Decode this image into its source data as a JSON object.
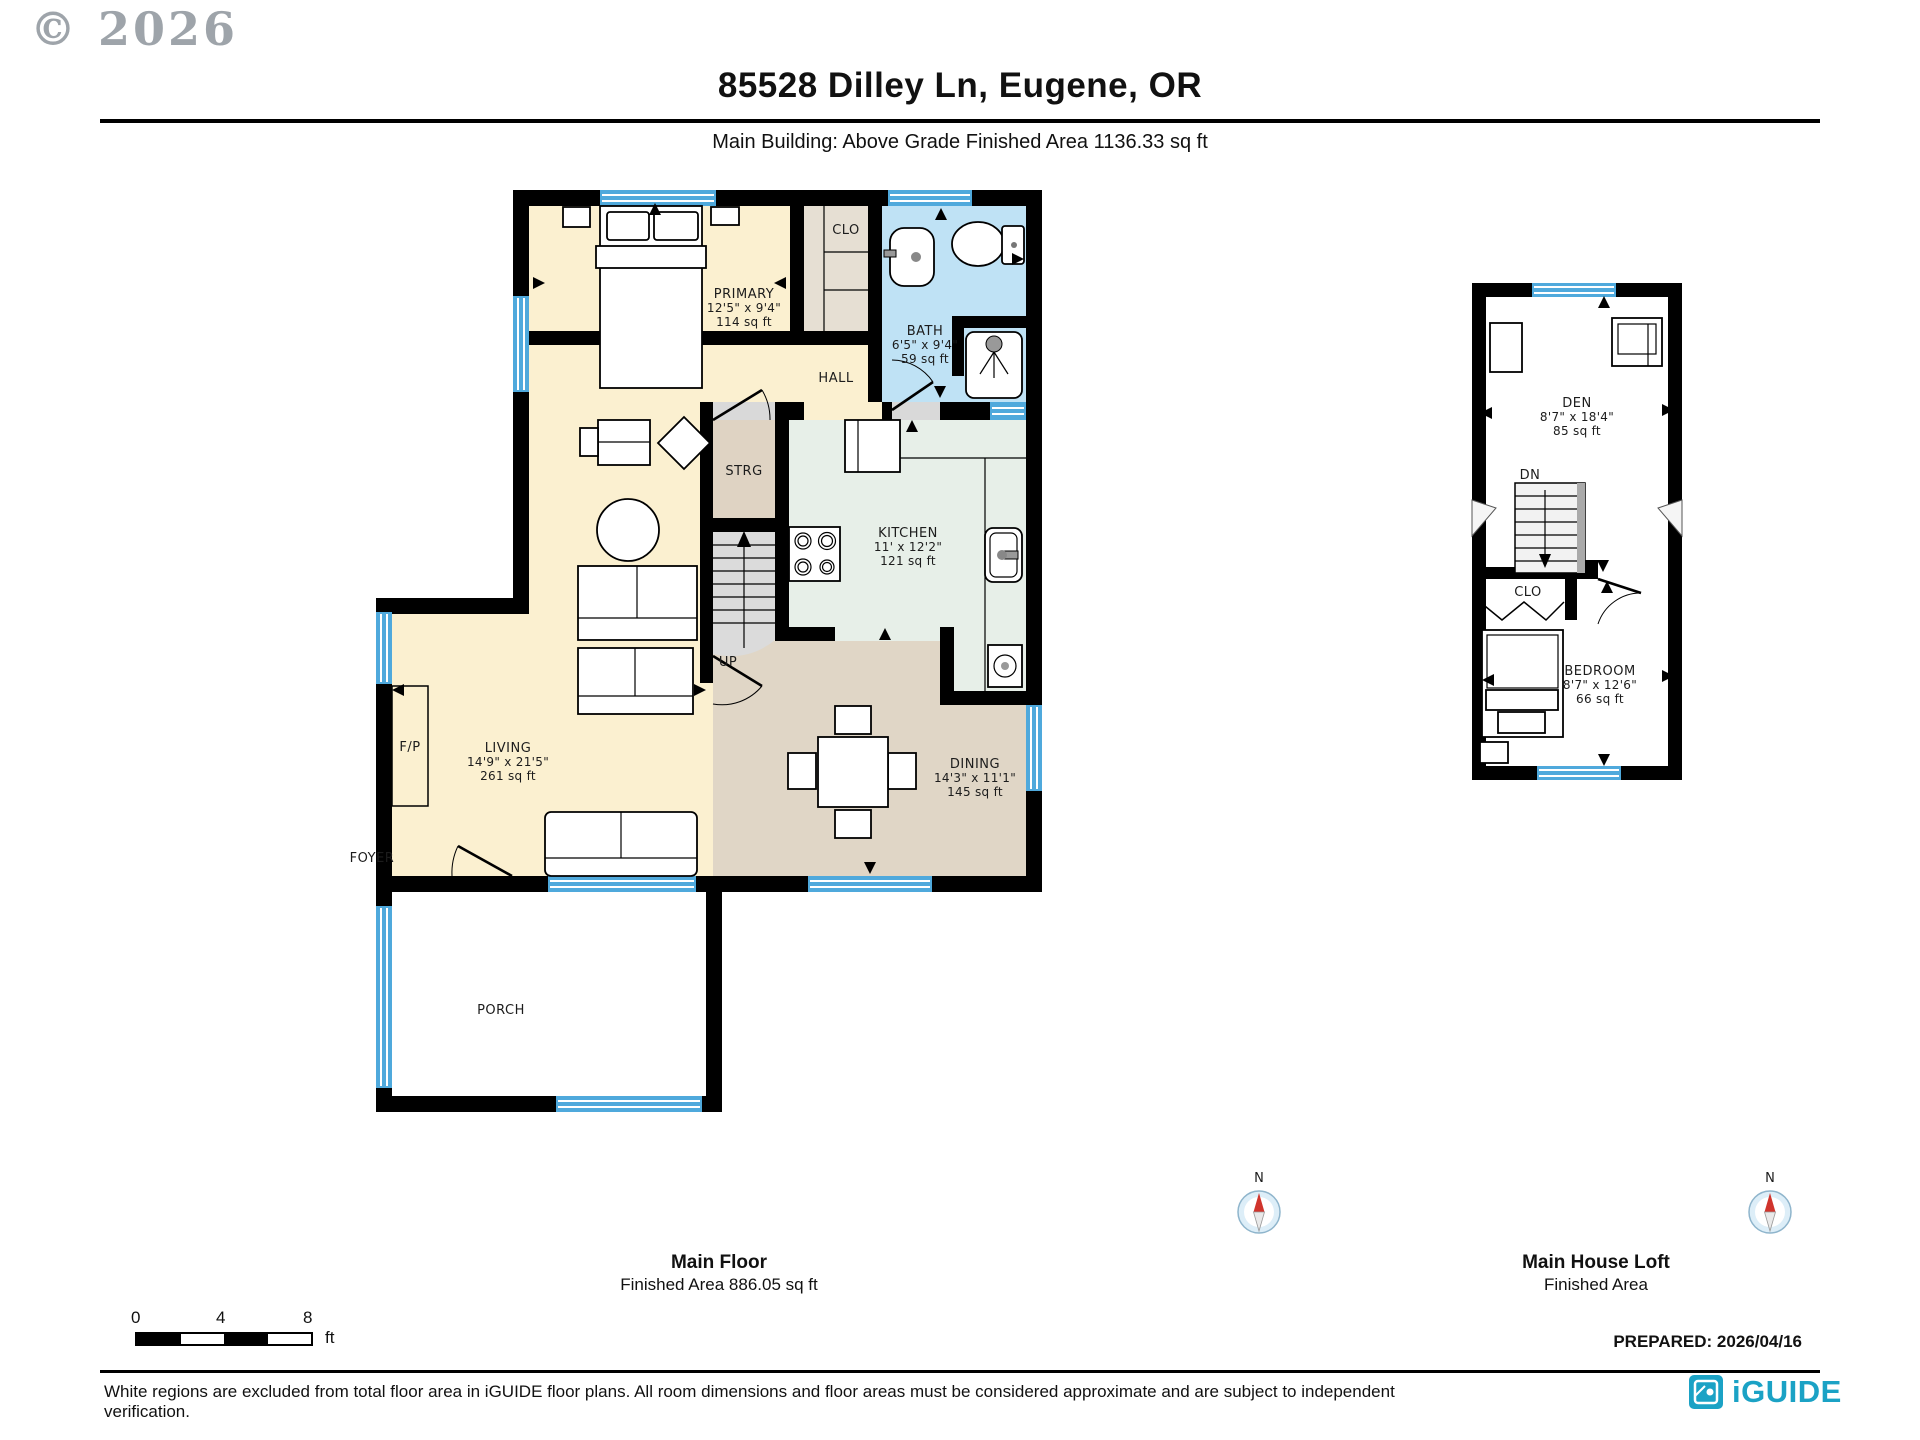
{
  "watermark": "© 2026",
  "header": {
    "title": "85528 Dilley Ln, Eugene, OR",
    "subtitle": "Main Building: Above Grade Finished Area 1136.33 sq ft"
  },
  "main_floor": {
    "caption": "Main Floor",
    "area_caption": "Finished Area 886.05 sq ft",
    "rooms": {
      "primary": {
        "label": "PRIMARY",
        "dims": "12'5\" x 9'4\"",
        "area": "114 sq ft"
      },
      "clo": {
        "label": "CLO"
      },
      "bath": {
        "label": "BATH",
        "dims": "6'5\" x 9'4\"",
        "area": "59 sq ft"
      },
      "hall": {
        "label": "HALL"
      },
      "strg": {
        "label": "STRG"
      },
      "stairs": {
        "label": "UP"
      },
      "kitchen": {
        "label": "KITCHEN",
        "dims": "11' x 12'2\"",
        "area": "121 sq ft"
      },
      "living": {
        "label": "LIVING",
        "dims": "14'9\" x 21'5\"",
        "area": "261 sq ft"
      },
      "fireplace": {
        "label": "F/P"
      },
      "foyer": {
        "label": "FOYER"
      },
      "dining": {
        "label": "DINING",
        "dims": "14'3\" x 11'1\"",
        "area": "145 sq ft"
      },
      "porch": {
        "label": "PORCH"
      }
    }
  },
  "loft": {
    "caption": "Main House Loft",
    "area_caption": "Finished Area",
    "rooms": {
      "den": {
        "label": "DEN",
        "dims": "8'7\" x 18'4\"",
        "area": "85 sq ft"
      },
      "stairs": {
        "label": "DN"
      },
      "clo": {
        "label": "CLO"
      },
      "bedroom": {
        "label": "BEDROOM",
        "dims": "8'7\" x 12'6\"",
        "area": "66 sq ft"
      }
    }
  },
  "compass": {
    "north_label": "N"
  },
  "scale_bar": {
    "ticks": [
      "0",
      "4",
      "8"
    ],
    "unit": "ft"
  },
  "prepared_label": "PREPARED: 2026/04/16",
  "footer": {
    "disclaimer": "White regions are excluded from total floor area in iGUIDE floor plans. All room dimensions and floor areas must be considered approximate and are subject to independent verification.",
    "brand": "iGUIDE"
  },
  "colors": {
    "wall": "#000000",
    "window_glass": "#4FA9DC",
    "floor_cream": "#FBF0D0",
    "floor_bath_blue": "#BFE2F5",
    "floor_closet": "#E6DFD3",
    "floor_storage": "#DFD3C3",
    "floor_kitchen": "#E7EFE8",
    "floor_dining": "#E0D6C6",
    "stairs_gray": "#DBDBDB",
    "brand_teal": "#1BA2C5",
    "compass_north_red": "#D0342C"
  }
}
